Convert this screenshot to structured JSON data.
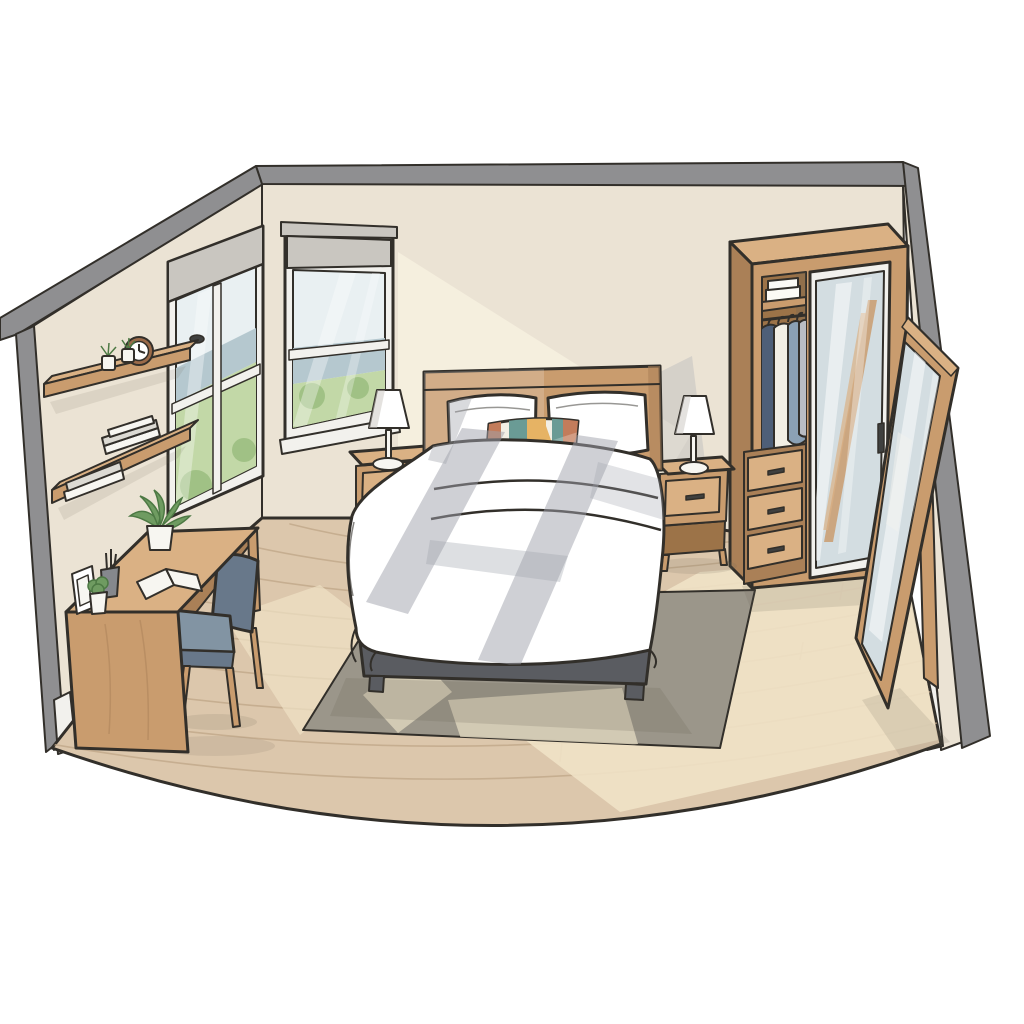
{
  "meta": {
    "type": "illustration",
    "subject": "Minimalist bedroom interior, isometric cutaway view with sunlight",
    "canvas_width": 1024,
    "canvas_height": 1024
  },
  "palette": {
    "ink": "#322f2a",
    "wall": "#ebe3d4",
    "wallLight": "#f8f1e0",
    "edge": "#8f8f91",
    "floor": "#dcc7ac",
    "floorLine": "#c0a789",
    "sunFloor": "#f0e2c6",
    "rug": "#9b968a",
    "rugLight": "#d8cfb8",
    "wood": "#c99c6e",
    "woodLight": "#dab184",
    "woodDark": "#aa8057",
    "woodInner": "#9c7348",
    "frame": "#f2f1ed",
    "shade": "#c9c6c0",
    "sky": "#e9f0f2",
    "mount": "#b5c8cf",
    "grass": "#c2d8a7",
    "grassDark": "#9cbf82",
    "leaf": "#6f9b61",
    "leafDark": "#4d7944",
    "bedBase": "#5a5c61",
    "bedShadow": "#9fa2ab",
    "chair": "#8294a3",
    "chairDark": "#68788a",
    "mirror": "#d3dde1",
    "white": "#ffffff",
    "paper": "#f7f6f1",
    "towel": "#fbfaf5",
    "bookGray": "#dcdad3",
    "clothNavy": "#4e5f78",
    "clothCream": "#f2efe5",
    "clothBlue": "#8ba1b5",
    "clothGray": "#b9bdc3",
    "terracotta": "#c37c5b",
    "teal": "#6a9b95",
    "mustard": "#e6b364",
    "clockRim": "#9a6a49",
    "cup": "#85888d",
    "dark": "#3f403f",
    "shadow": "#6b6355"
  },
  "scene": {
    "objects": [
      "left-wall",
      "back-wall",
      "right-wall",
      "wood-floor",
      "area-rug",
      "window-left",
      "window-right",
      "roller-shades",
      "outdoor-view-hills",
      "wall-shelf-upper",
      "wall-shelf-lower",
      "alarm-clock",
      "shelf-plants",
      "book-stacks",
      "desk",
      "desk-plant",
      "picture-frame",
      "pen-cup",
      "small-plant",
      "open-book",
      "desk-chair",
      "bed",
      "headboard",
      "pillows",
      "accent-pillow",
      "duvet",
      "bed-frame",
      "nightstand-left",
      "nightstand-right",
      "table-lamp-left",
      "table-lamp-right",
      "wardrobe",
      "folded-towels",
      "hanging-clothes",
      "wardrobe-drawers",
      "mirrored-door",
      "standing-mirror",
      "sunlight-patches",
      "window-shadow-on-bed"
    ],
    "counts": {
      "windows": 2,
      "wall_shelves": 2,
      "bed_pillows": 2,
      "nightstands": 2,
      "table_lamps": 2,
      "wardrobe_drawers": 3,
      "hanging_garments": 4,
      "towel_stacks": 2
    }
  }
}
